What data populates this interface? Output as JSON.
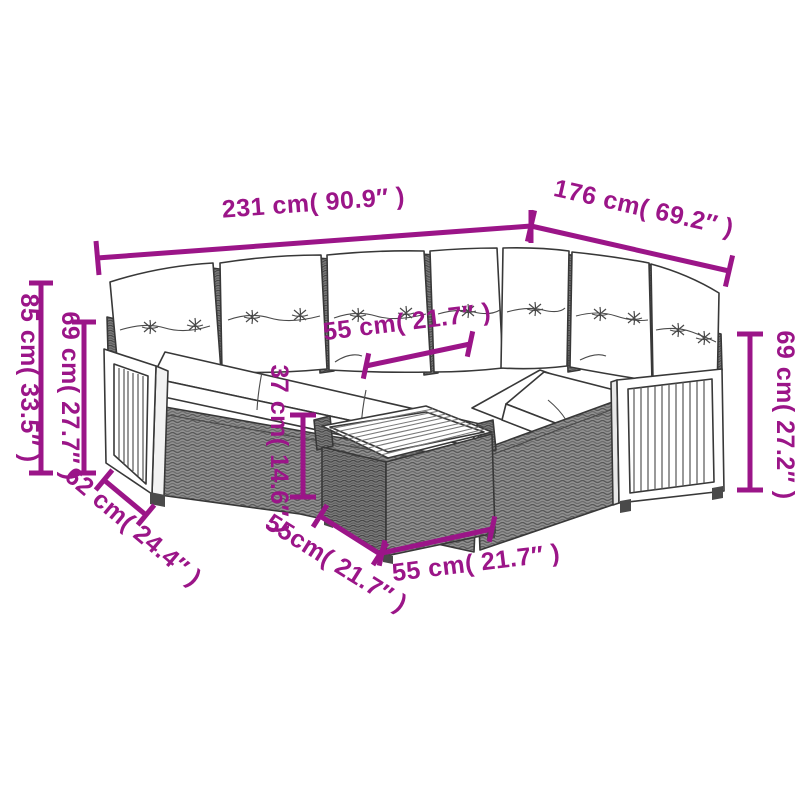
{
  "diagram": {
    "kind": "furniture-dimension-diagram",
    "background": "#ffffff",
    "colors": {
      "dimension_annotation": "#9B1588",
      "drawing_outline": "#383838",
      "wicker_gray": "#909090",
      "wicker_dark": "#7a7a7a",
      "cushion_white": "#ffffff"
    },
    "dimensions": {
      "sofa_total_length": "231 cm( 90.9″ )",
      "sofa_side_length": "176 cm( 69.2″ )",
      "back_height": "85 cm( 33.5″ )",
      "arm_height_left": "69 cm( 27.7″ )",
      "seat_depth": "62 cm( 24.4″ )",
      "seat_width": "55 cm( 21.7″ )",
      "table_height": "37 cm( 14.6″ )",
      "table_depth": "55cm( 21.7″ )",
      "table_width": "55 cm( 21.7″ )",
      "arm_height_right": "69 cm( 27.2″ )"
    }
  }
}
